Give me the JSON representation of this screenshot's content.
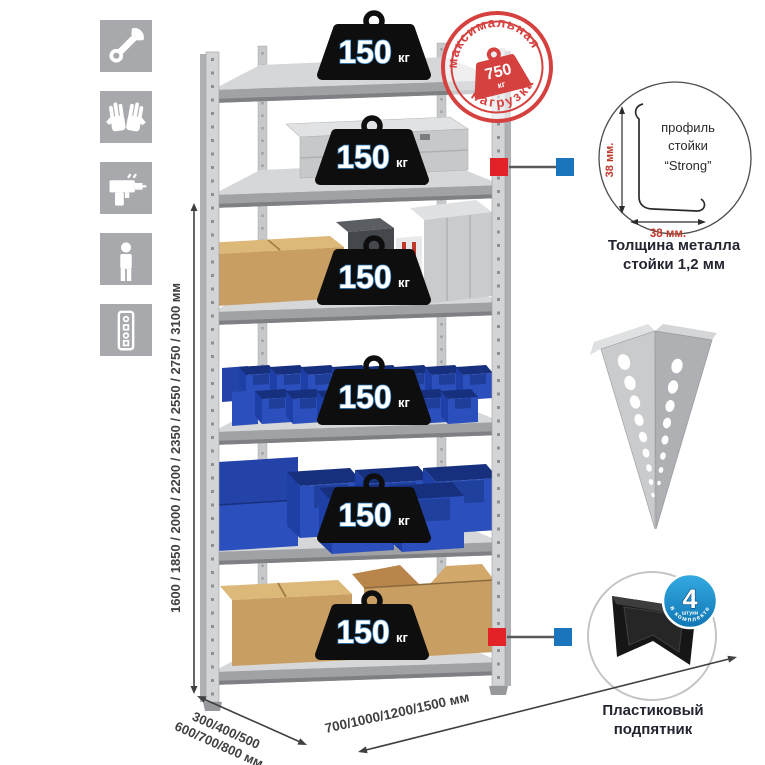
{
  "colors": {
    "icon_gray": "#a7a9ac",
    "metal_light": "#d5d6d8",
    "metal_band": "#a0a2a5",
    "weight_black": "#0e0e0e",
    "stamp_red": "#d5413f",
    "connector_red": "#e32227",
    "connector_blue": "#1b75bc",
    "badge_blue": "#1e96d5",
    "bin_blue": "#2b50bd",
    "cardboard": "#c89e63",
    "text_dark": "#3f4042"
  },
  "left_icons": [
    {
      "name": "wrench-icon"
    },
    {
      "name": "gloves-icon"
    },
    {
      "name": "drill-icon"
    },
    {
      "name": "person-icon"
    },
    {
      "name": "perforated-profile-icon"
    }
  ],
  "dimensions": {
    "height": "1600 / 1850 / 2000 / 2200 / 2350 / 2550 / 2750 / 3100 мм",
    "depth_line1": "300/400/500",
    "depth_line2": "600/700/800 мм",
    "width": "700/1000/1200/1500 мм"
  },
  "weights": {
    "items": [
      {
        "value": "150",
        "unit": "кг"
      },
      {
        "value": "150",
        "unit": "кг"
      },
      {
        "value": "150",
        "unit": "кг"
      },
      {
        "value": "150",
        "unit": "кг"
      },
      {
        "value": "150",
        "unit": "кг"
      },
      {
        "value": "150",
        "unit": "кг"
      }
    ]
  },
  "stamp": {
    "arc_top": "максимальная",
    "arc_bottom": "нагрузка",
    "value": "750",
    "unit": "кг"
  },
  "profile": {
    "label_line1": "профиль",
    "label_line2": "стойки",
    "label_line3": "“Strong”",
    "dim_left": "38 мм.",
    "dim_bottom": "38 мм.",
    "caption_line1": "Толщина металла",
    "caption_line2": "стойки 1,2 мм"
  },
  "foot": {
    "badge_value": "4",
    "badge_unit": "штуки",
    "badge_arc": "в комплекте",
    "caption_line1": "Пластиковый",
    "caption_line2": "подпятник"
  }
}
